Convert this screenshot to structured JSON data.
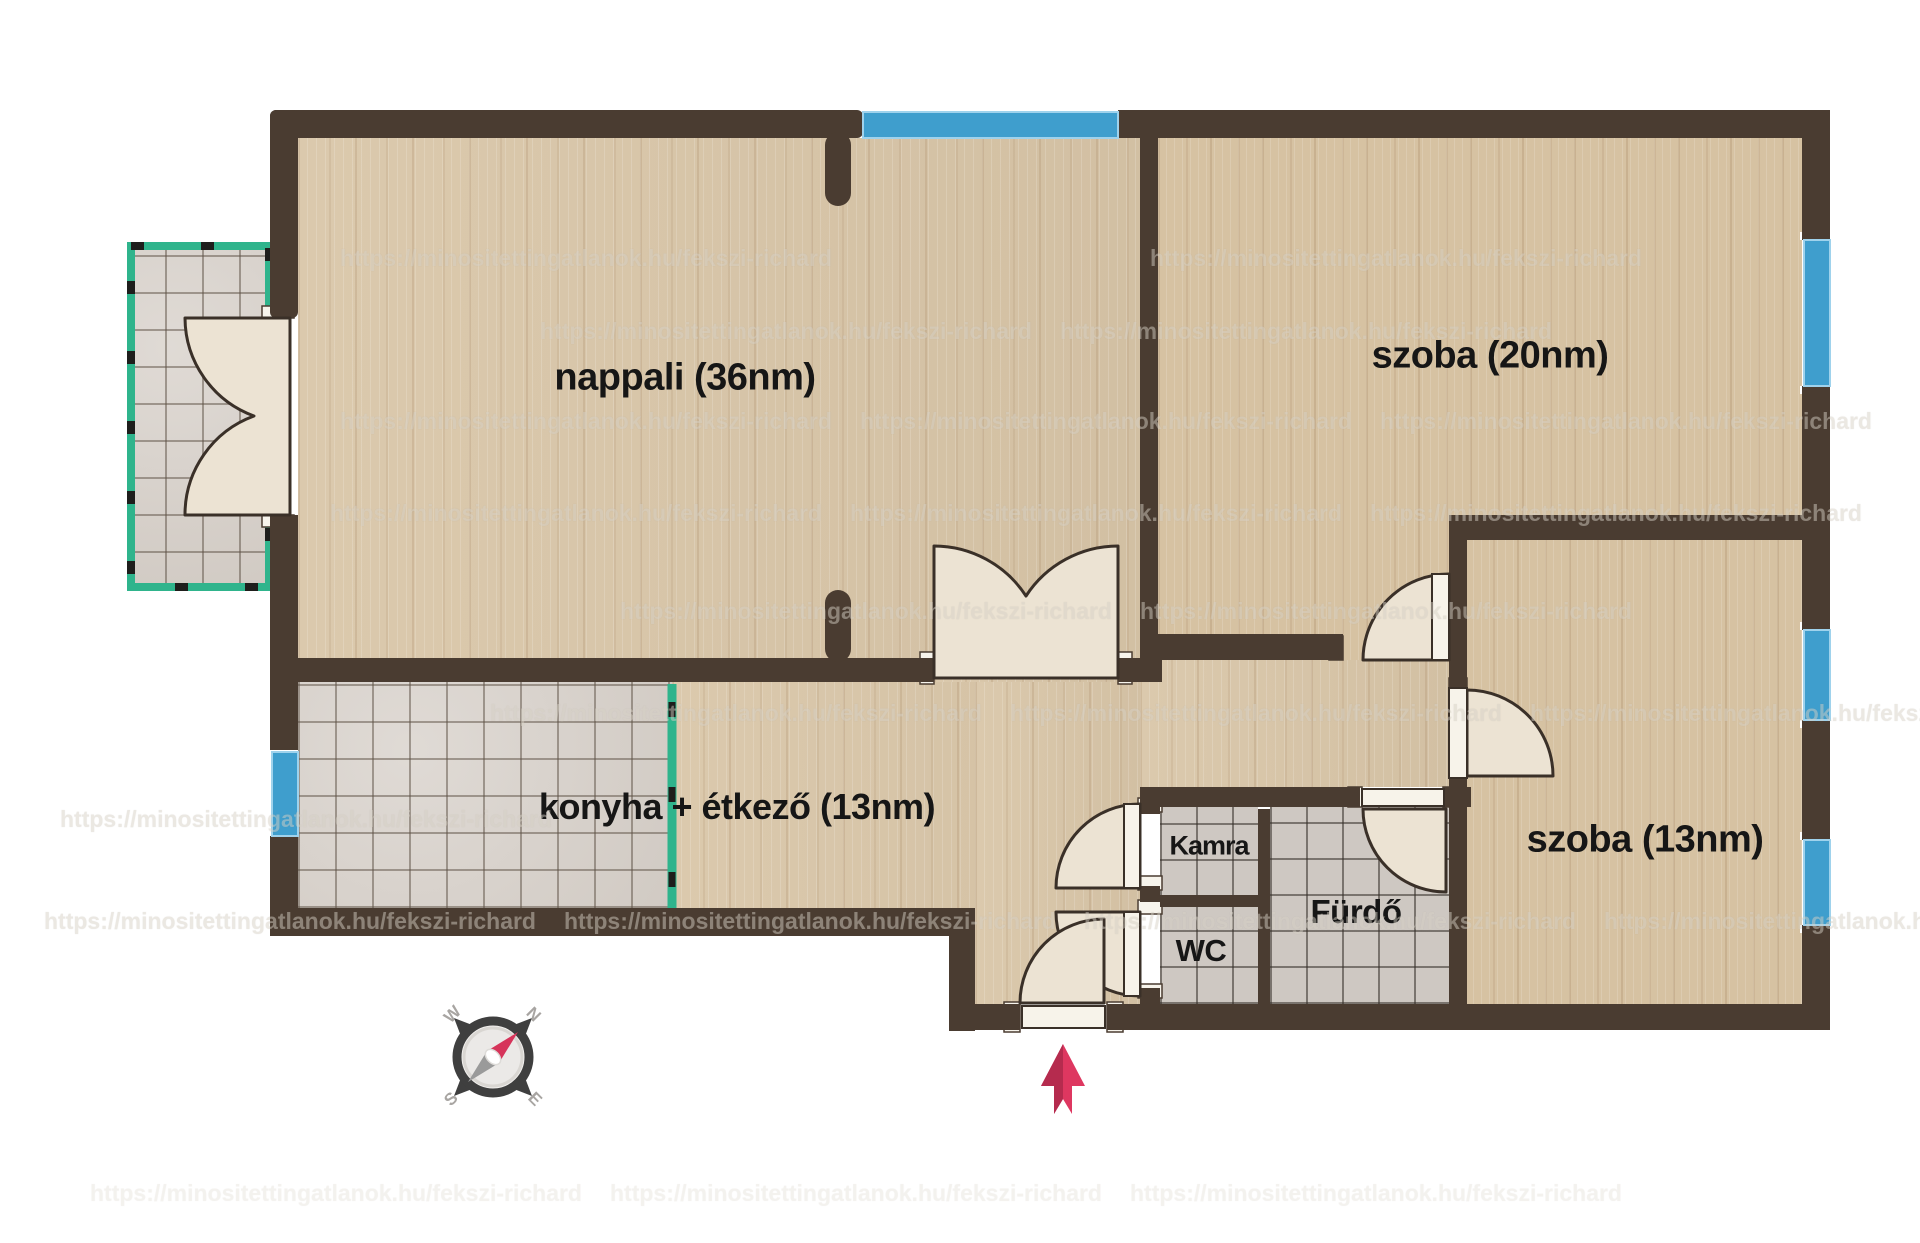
{
  "rooms": [
    {
      "id": "nappali",
      "label": "nappali (36nm)"
    },
    {
      "id": "szoba20",
      "label": "szoba (20nm)"
    },
    {
      "id": "szoba13",
      "label": "szoba (13nm)"
    },
    {
      "id": "konyha",
      "label": "konyha + étkező (13nm)"
    },
    {
      "id": "kamra",
      "label": "Kamra"
    },
    {
      "id": "wc",
      "label": "WC"
    },
    {
      "id": "furdo",
      "label": "Fürdő"
    }
  ],
  "compass": {
    "n": "N",
    "e": "E",
    "s": "S",
    "w": "W"
  },
  "watermark": {
    "text": "https://minositettingatlanok.hu/fekszi-richard"
  },
  "colors": {
    "wall": "#4a3c31",
    "wood_floor": "#d9c6a8",
    "tile_floor": "#d5cec7",
    "window_blue": "#3f9ecd",
    "terrace_teal": "#2fb48c",
    "door_leaf": "#ece3d3",
    "entrance_arrow_red": "#de3760",
    "label_text": "#161616"
  }
}
